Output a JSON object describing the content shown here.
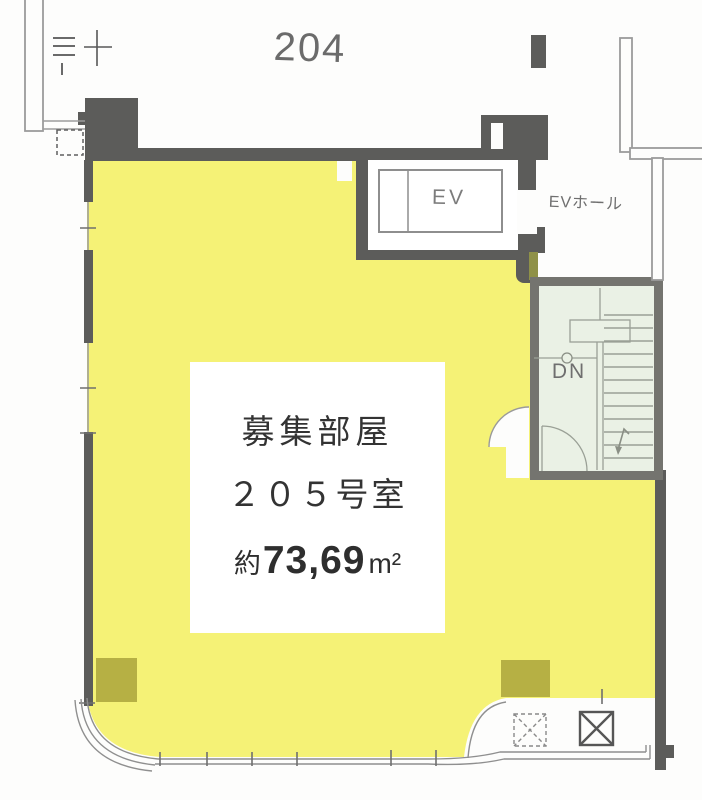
{
  "plan": {
    "neighbor_room_label": "204",
    "elevator_label": "EV",
    "elevator_hall_label": "EVホール",
    "stairs_down_label": "DN",
    "room_info": {
      "status": "募集部屋",
      "room_number": "２０５号室",
      "area_prefix": "約",
      "area_value": "73,69",
      "area_unit": "m²"
    },
    "colors": {
      "room_highlight": "#f5f276",
      "column_block": "#b6b044",
      "wall_dark": "#5c5c5a",
      "stair_wall": "#74746f",
      "stair_fill": "#eaf1e5",
      "line_gray": "#8f8f8f"
    }
  }
}
